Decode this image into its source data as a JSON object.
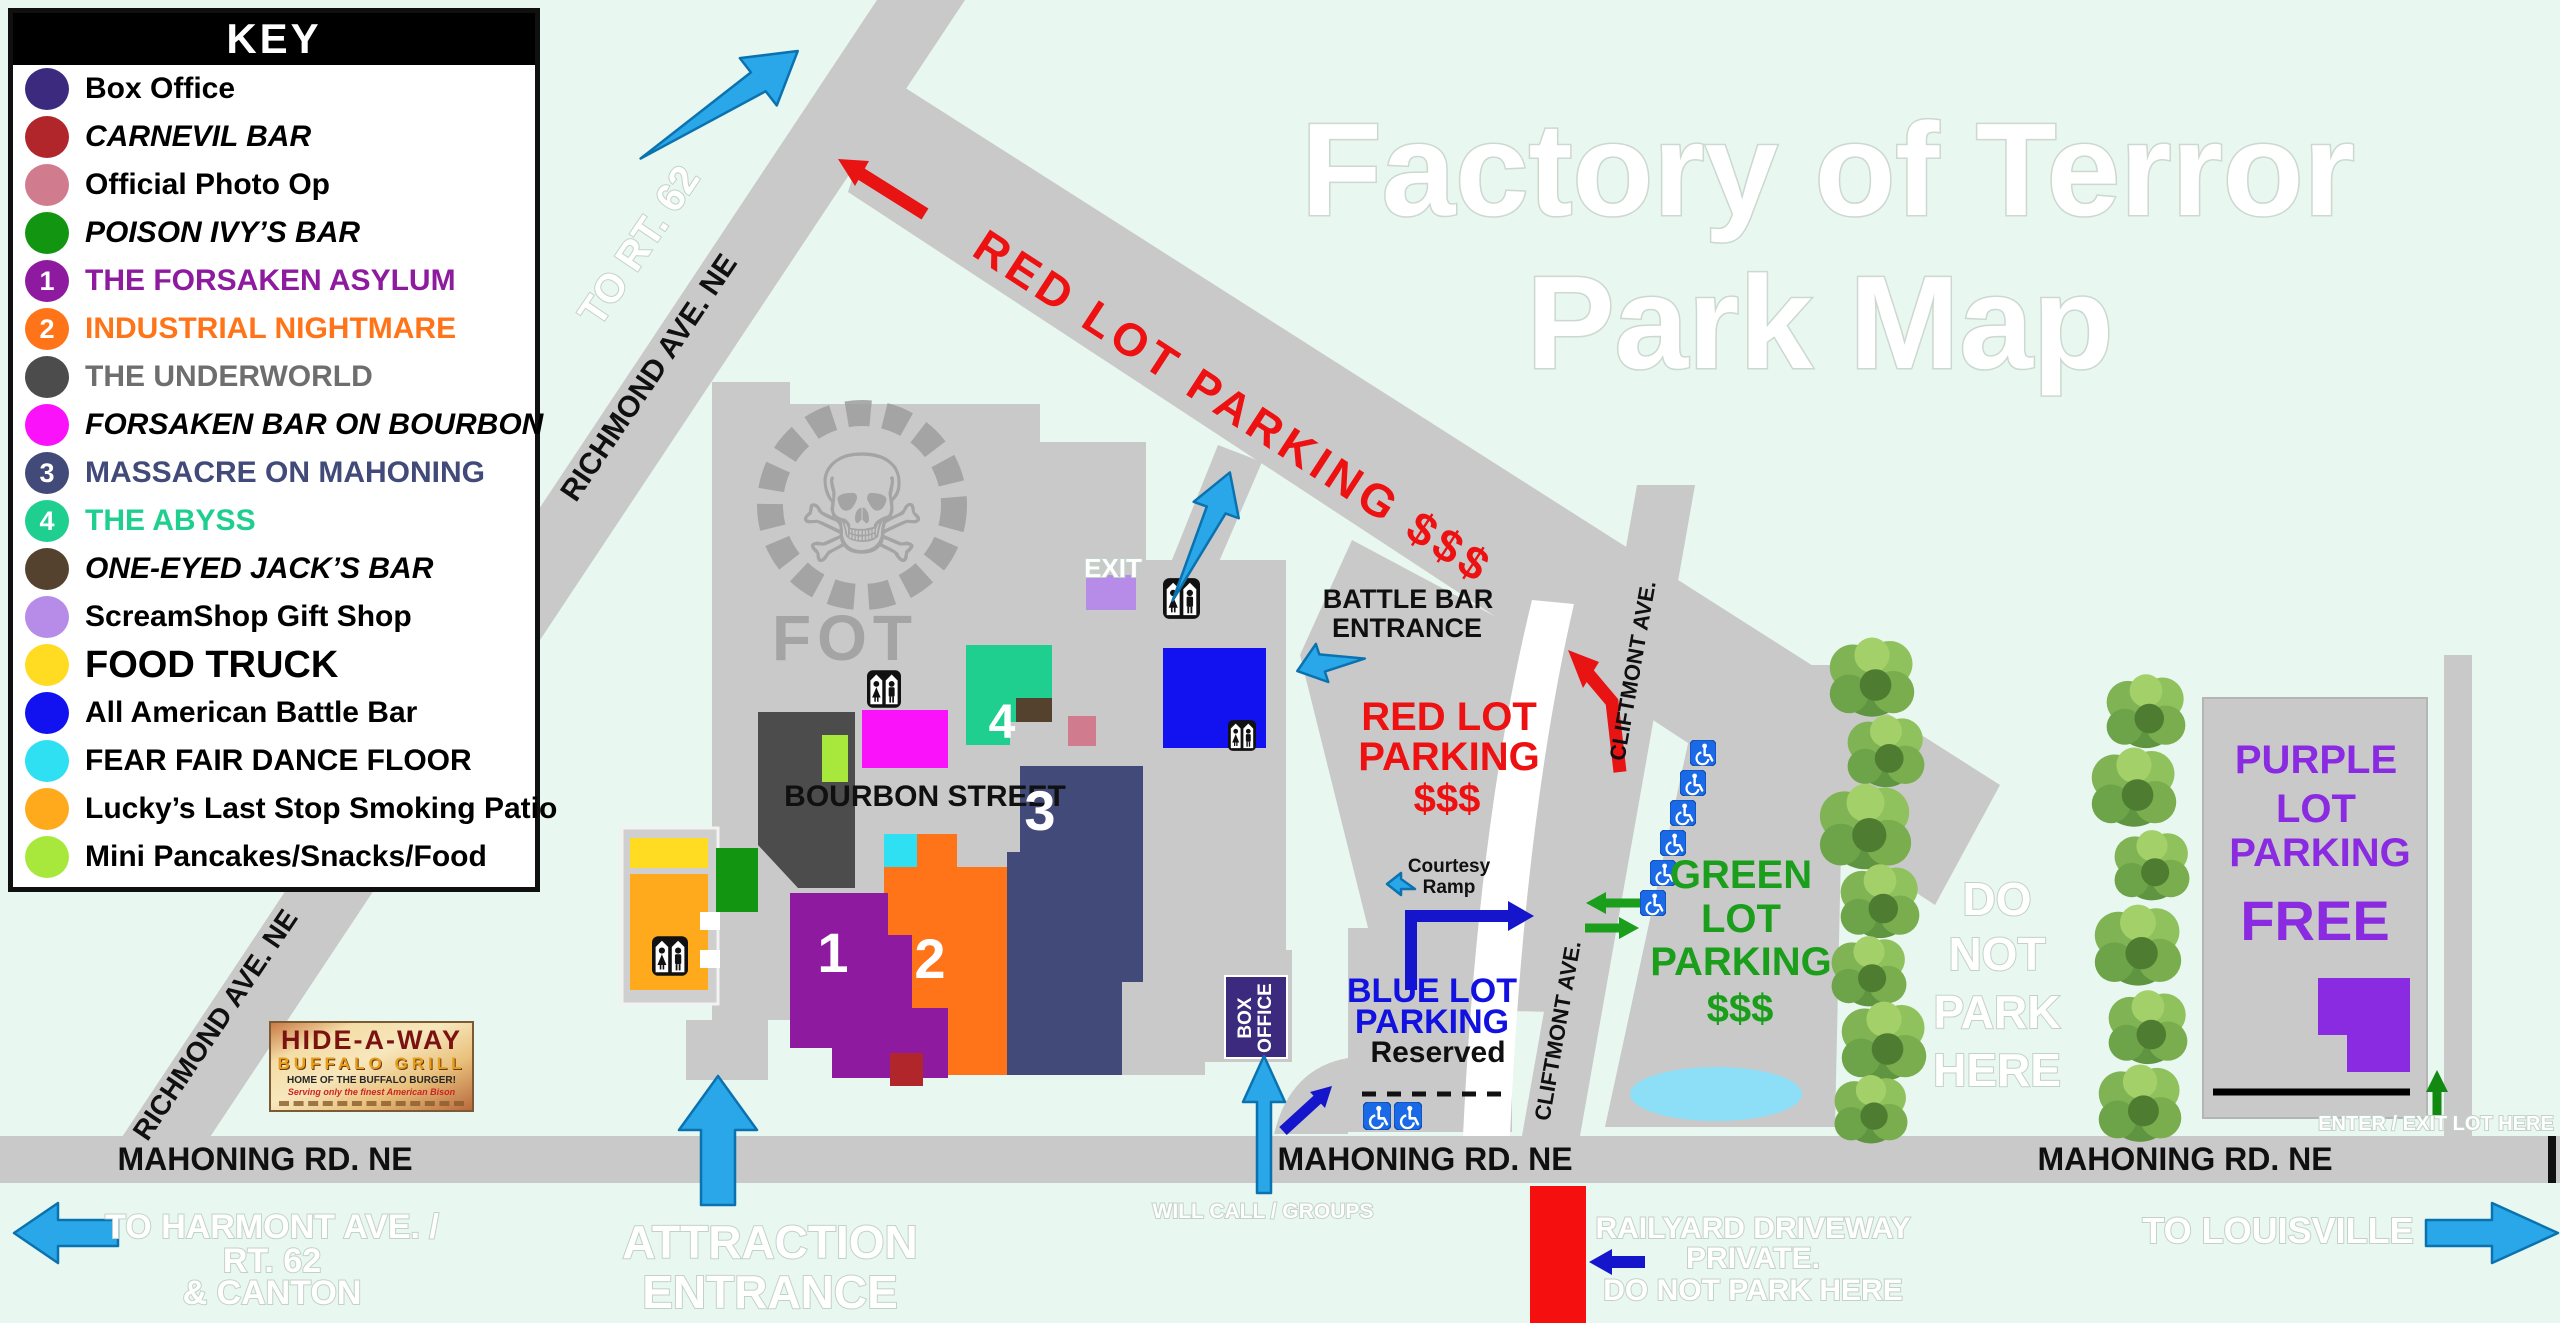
{
  "title": {
    "line1": "Factory of Terror",
    "line2": "Park Map"
  },
  "key": {
    "header": "KEY",
    "items": [
      {
        "label": "Box Office",
        "color": "#3b2a7e"
      },
      {
        "label": "CARNEVIL BAR",
        "color": "#b1262b",
        "italic": true
      },
      {
        "label": "Official Photo Op",
        "color": "#d07c8e"
      },
      {
        "label": "POISON IVY’S BAR",
        "color": "#129612",
        "italic": true
      },
      {
        "label": "THE FORSAKEN ASYLUM",
        "color": "#8e1b9f",
        "text_color": "#8e1b9f",
        "badge": "1"
      },
      {
        "label": "INDUSTRIAL NIGHTMARE",
        "color": "#ff7419",
        "text_color": "#ff7419",
        "badge": "2"
      },
      {
        "label": "THE UNDERWORLD",
        "color": "#4c4c4c",
        "text_color": "#6e6e6e"
      },
      {
        "label": "FORSAKEN BAR ON BOURBON",
        "color": "#fa12fa",
        "italic": true
      },
      {
        "label": "MASSACRE ON MAHONING",
        "color": "#414a78",
        "text_color": "#414a78",
        "badge": "3"
      },
      {
        "label": "THE ABYSS",
        "color": "#1ecf90",
        "text_color": "#1ecf90",
        "badge": "4"
      },
      {
        "label": "ONE-EYED JACK’S BAR",
        "color": "#54422e",
        "italic": true
      },
      {
        "label": "ScreamShop Gift Shop",
        "color": "#b68ce8"
      },
      {
        "label": "FOOD TRUCK",
        "color": "#ffdb21",
        "large": true
      },
      {
        "label": "All American Battle Bar",
        "color": "#1212f0"
      },
      {
        "label": "FEAR FAIR DANCE FLOOR",
        "color": "#2ee0f2"
      },
      {
        "label": "Lucky’s Last Stop Smoking Patio",
        "color": "#ffaa1c"
      },
      {
        "label": "Mini Pancakes/Snacks/Food",
        "color": "#a8e83c"
      }
    ]
  },
  "roads": {
    "mahoning": "MAHONING RD. NE",
    "richmond": "RICHMOND AVE. NE",
    "cliftmont": "CLIFTMONT AVE."
  },
  "directions": {
    "to_rt62": "TO RT. 62",
    "to_harmont": [
      "TO HARMONT AVE. /",
      "RT. 62",
      "& CANTON"
    ],
    "to_louisville": "TO LOUISVILLE",
    "attraction_entrance": [
      "ATTRACTION",
      "ENTRANCE"
    ],
    "will_call": "WILL CALL / GROUPS",
    "railyard": [
      "RAILYARD DRIVEWAY",
      "PRIVATE.",
      "DO NOT PARK HERE"
    ],
    "do_not_park": [
      "DO",
      "NOT",
      "PARK",
      "HERE"
    ],
    "enter_exit": "ENTER / EXIT LOT HERE",
    "exit": "EXIT"
  },
  "parking": {
    "red_road_label": "RED LOT PARKING $$$",
    "red": [
      "RED LOT",
      "PARKING",
      "$$$"
    ],
    "green": [
      "GREEN",
      "LOT",
      "PARKING",
      "$$$"
    ],
    "blue": {
      "lines": [
        "BLUE LOT",
        "PARKING"
      ],
      "reserved": "Reserved"
    },
    "purple": {
      "lines": [
        "PURPLE",
        "LOT",
        "PARKING"
      ],
      "free": "FREE"
    }
  },
  "labels": {
    "battle_bar_entrance": [
      "BATTLE BAR",
      "ENTRANCE"
    ],
    "bourbon_street": "BOURBON STREET",
    "courtesy_ramp": [
      "Courtesy",
      "Ramp"
    ],
    "box_office": [
      "BOX",
      "OFFICE"
    ],
    "fot": "FOT",
    "numbers": {
      "asylum": "1",
      "industrial": "2",
      "massacre": "3",
      "abyss": "4"
    }
  },
  "sign": {
    "line1": "HIDE-A-WAY",
    "line2": "BUFFALO GRILL",
    "line3": "HOME OF THE BUFFALO BURGER!",
    "line4": "Serving only the finest American Bison"
  },
  "colors": {
    "background": "#e8f7ef",
    "road": "#c9c9c9",
    "red_text": "#ee1111",
    "green_text": "#1b9e1b",
    "blue_text": "#1212e0",
    "violet_text": "#8a2be2",
    "light_blue_arrow": "#2aa7e8",
    "dark_blue_arrow": "#1515cc"
  }
}
